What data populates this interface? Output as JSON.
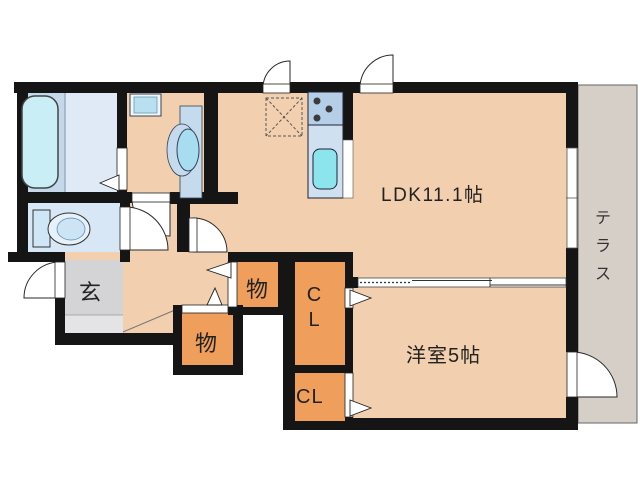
{
  "floorplan": {
    "rooms": {
      "ldk": {
        "label": "LDK11.1帖"
      },
      "western_room": {
        "label": "洋室5帖"
      },
      "terrace": {
        "label": "テラス"
      },
      "entrance": {
        "label": "玄"
      },
      "storage_upper": {
        "label": "物"
      },
      "storage_lower": {
        "label": "物"
      },
      "closet_upper": {
        "label": "CL"
      },
      "closet_lower": {
        "label": "CL"
      }
    },
    "fixtures": [
      "bathtub",
      "bathroom",
      "washing-machine-pan",
      "washbasin",
      "toilet",
      "refrigerator-space",
      "stove-3-burner",
      "kitchen-sink",
      "sliding-door",
      "window",
      "hinged-doors",
      "folding-door-markers"
    ],
    "colors": {
      "floor_peach": "#f2cfae",
      "storage_orange": "#ef9e5c",
      "entrance_gray": "#d4d4d6",
      "entrance_gray_light": "#e4e4e6",
      "bath_blue_left": "#c5d8ea",
      "bath_blue_right": "#dfeaf6",
      "tub_cyan": "#c9eef6",
      "toilet_room_blue": "#d8e7f5",
      "stove_blue": "#b4cfe7",
      "counter_blue": "#cfe0f1",
      "sink_cyan": "#8ce4ed",
      "basin_blue": "#c6daee",
      "basin_bowl_blue": "#a8ddf1",
      "terrace_gray": "#d5cfc7",
      "wall_black": "#151515"
    }
  }
}
